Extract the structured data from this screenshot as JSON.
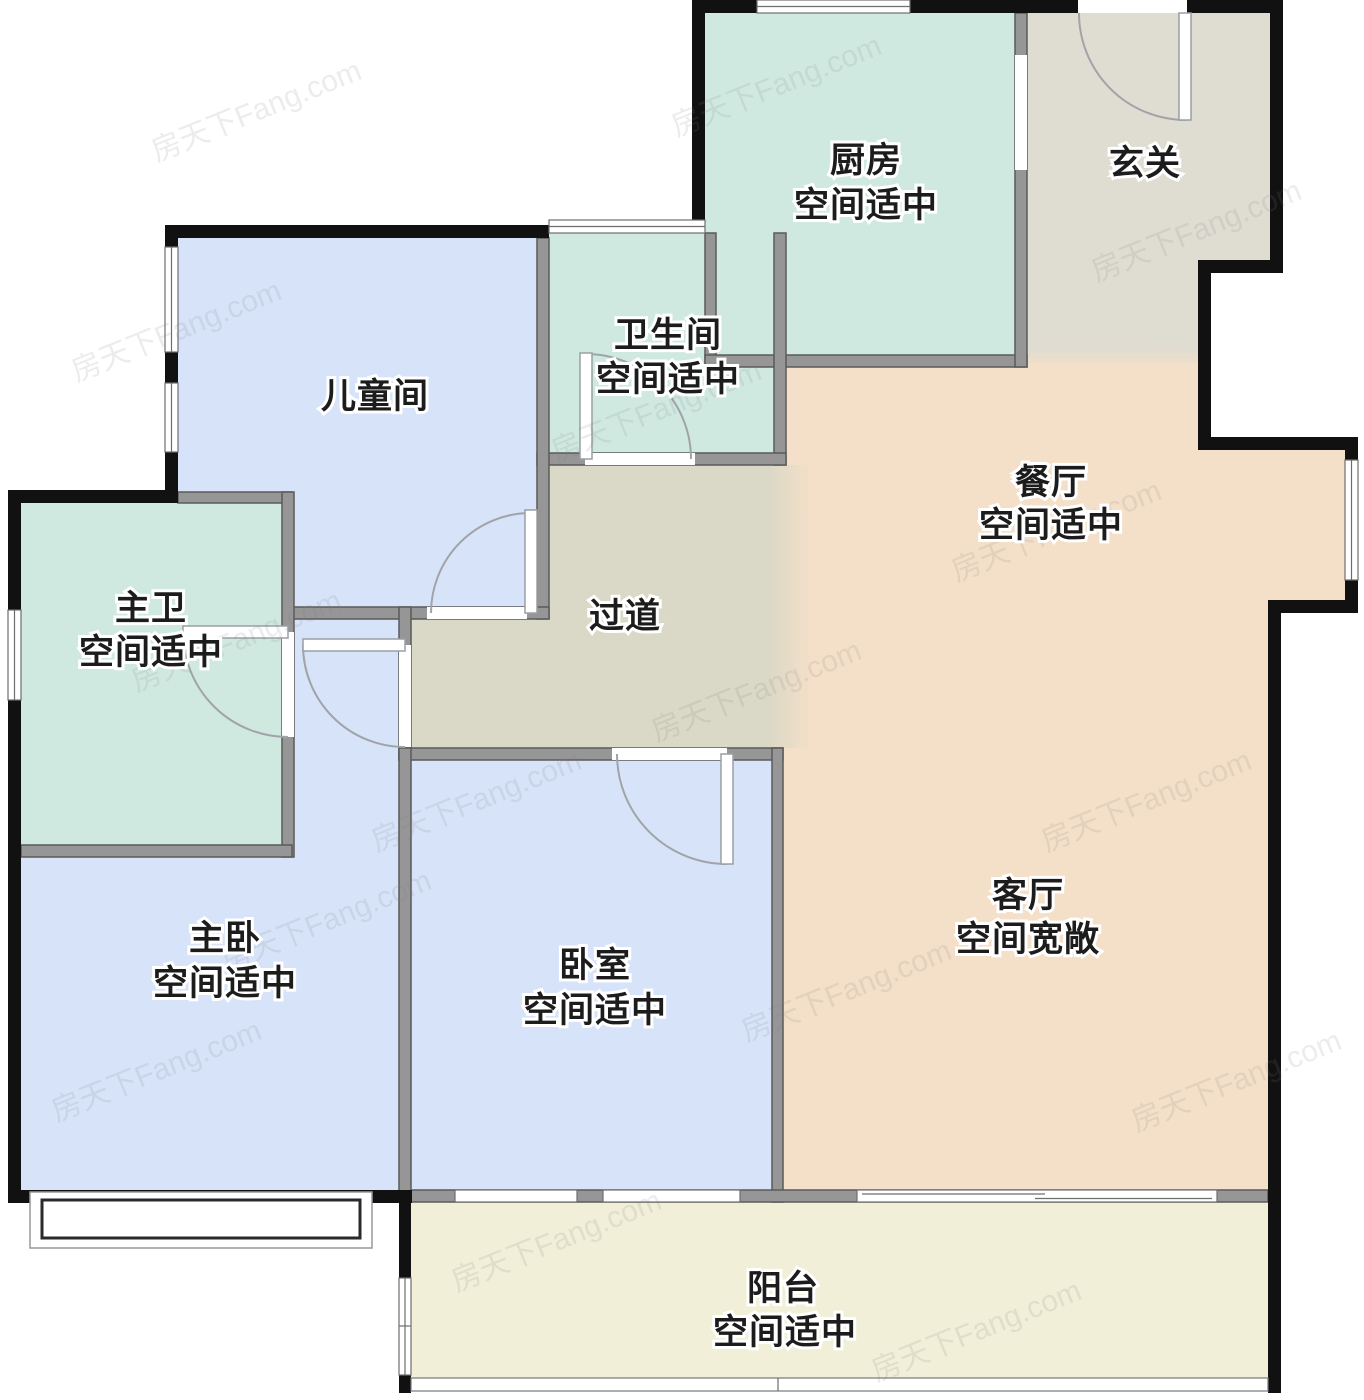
{
  "watermark": {
    "text": "房天下Fang.com"
  },
  "colors": {
    "mint": "#cfe9e1",
    "blue": "#d7e3f9",
    "peach": "#f4dfc8",
    "entry_gray": "#dfdcd1",
    "corridor_gray": "#dad8c6",
    "balcony_cream": "#f1efd8",
    "wall_black": "#111111",
    "wall_gray": "#969696"
  },
  "rooms": {
    "kitchen": {
      "name": "厨房",
      "note": "空间适中"
    },
    "entry": {
      "name": "玄关"
    },
    "bathroom": {
      "name": "卫生间",
      "note": "空间适中"
    },
    "children": {
      "name": "儿童间"
    },
    "dining": {
      "name": "餐厅",
      "note": "空间适中"
    },
    "master_bath": {
      "name": "主卫",
      "note": "空间适中"
    },
    "corridor": {
      "name": "过道"
    },
    "master_bedroom": {
      "name": "主卧",
      "note": "空间适中"
    },
    "bedroom": {
      "name": "卧室",
      "note": "空间适中"
    },
    "living": {
      "name": "客厅",
      "note": "空间宽敞"
    },
    "balcony": {
      "name": "阳台",
      "note": "空间适中"
    }
  }
}
